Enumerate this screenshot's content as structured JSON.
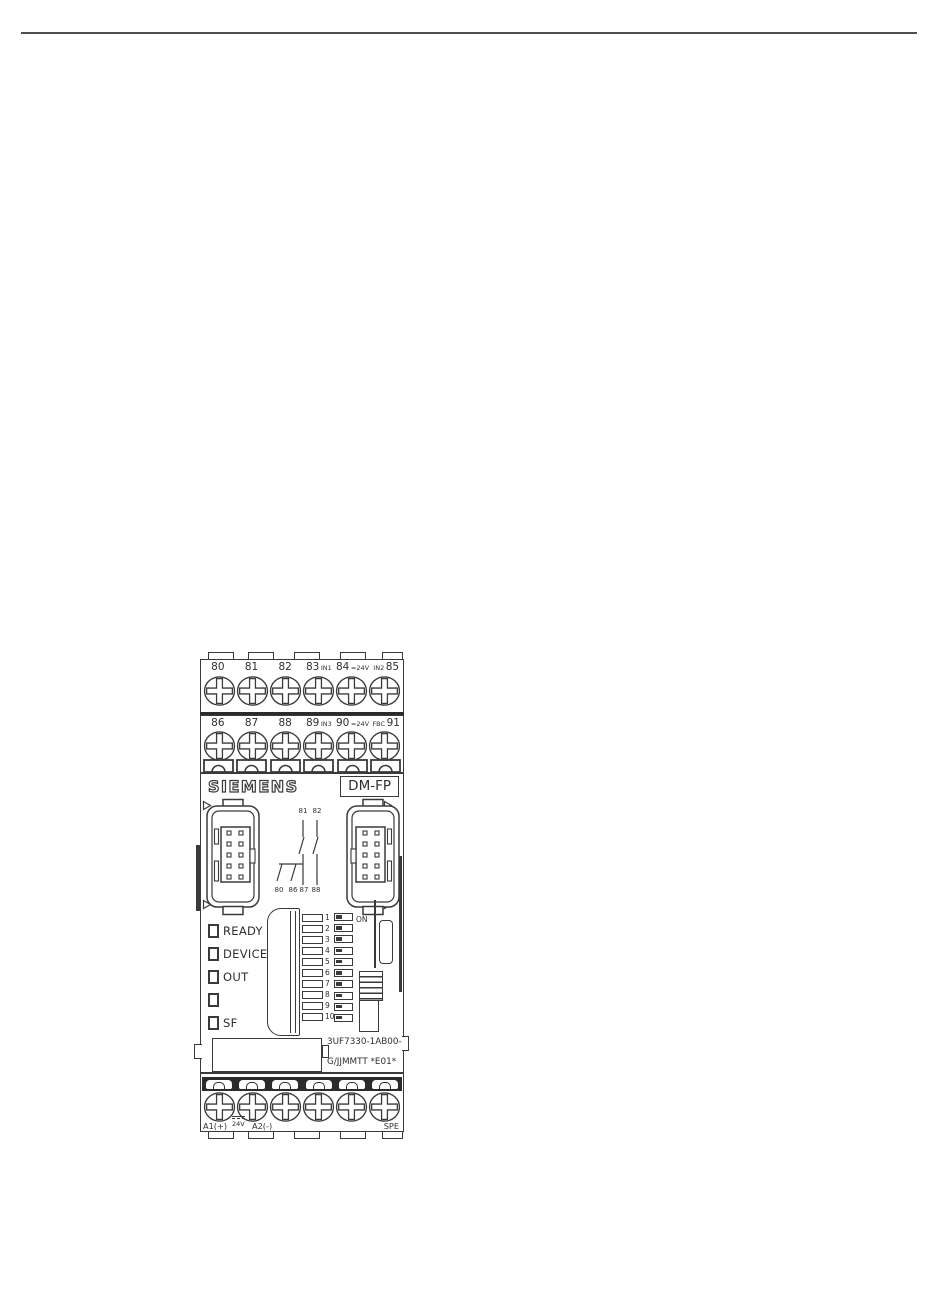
{
  "colors": {
    "line": "#3a3a3a",
    "ink": "#2e2e2e",
    "separator": "#2b2b2b",
    "page_bg": "#ffffff"
  },
  "device": {
    "brand": "SIEMENS",
    "model": "DM-FP",
    "part_number": "3UF7330-1AB00-0",
    "date_code": "G/JJMMTT *E01*",
    "terminals_row1": [
      {
        "num": "80",
        "sub": ""
      },
      {
        "num": "81",
        "sub": ""
      },
      {
        "num": "82",
        "sub": ""
      },
      {
        "num": "83",
        "sub": "IN1"
      },
      {
        "num": "84",
        "sub": "=24V"
      },
      {
        "num": "85",
        "sub": "IN2"
      }
    ],
    "terminals_row2": [
      {
        "num": "86",
        "sub": ""
      },
      {
        "num": "87",
        "sub": ""
      },
      {
        "num": "88",
        "sub": ""
      },
      {
        "num": "89",
        "sub": "IN3"
      },
      {
        "num": "90",
        "sub": "=24V"
      },
      {
        "num": "91",
        "sub": "FBC"
      }
    ],
    "schematic_top": [
      "81",
      "82"
    ],
    "schematic_bottom": [
      "80",
      "86",
      "87",
      "88"
    ],
    "leds": [
      "READY",
      "DEVICE",
      "OUT",
      "",
      "SF"
    ],
    "dip_numbers": [
      "1",
      "2",
      "3",
      "4",
      "5",
      "6",
      "7",
      "8",
      "9",
      "10"
    ],
    "dip_on_label": "ON",
    "bottom_terminals": {
      "a1": "A1(+)",
      "supply": "24V",
      "a2": "A2(-)",
      "spe": "SPE"
    }
  }
}
